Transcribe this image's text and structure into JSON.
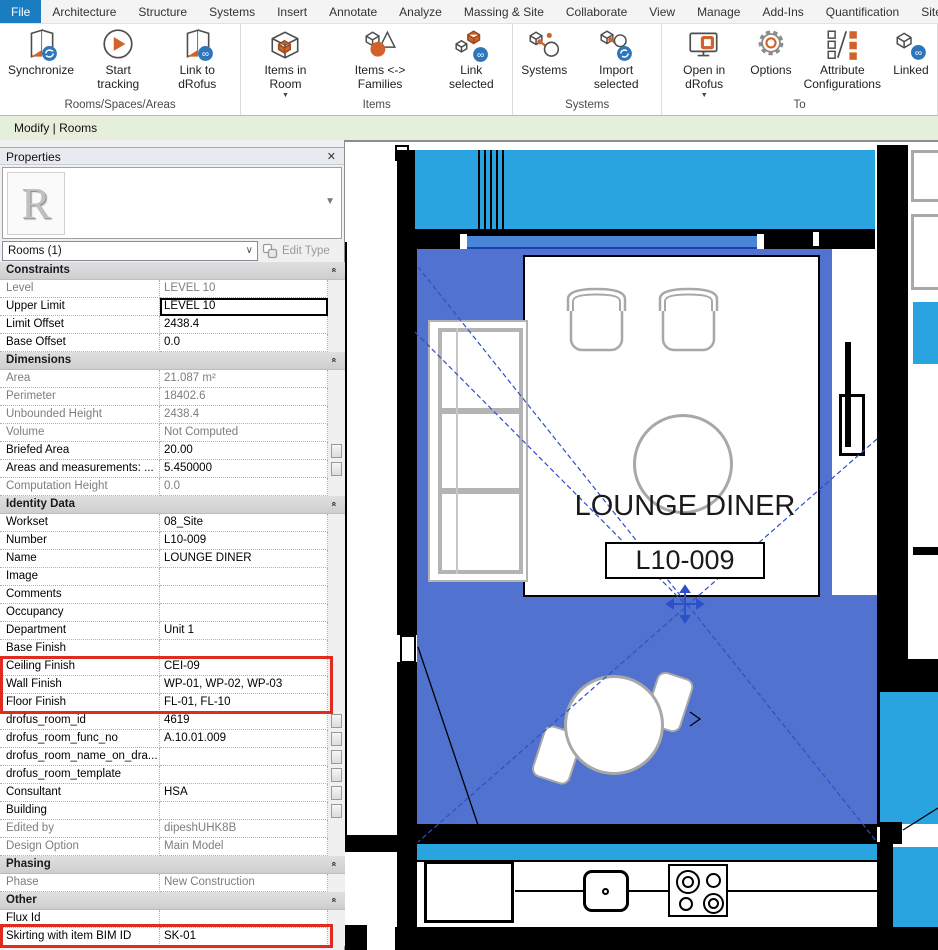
{
  "ui_colors": {
    "file_tab": "#1a7dc2",
    "highlight_red": "#e02b20",
    "accent_orange": "#d2622a",
    "drofus_blue": "#2d76bc"
  },
  "ribbon": {
    "tabs": [
      {
        "label": "File",
        "active": true
      },
      {
        "label": "Architecture"
      },
      {
        "label": "Structure"
      },
      {
        "label": "Systems"
      },
      {
        "label": "Insert"
      },
      {
        "label": "Annotate"
      },
      {
        "label": "Analyze"
      },
      {
        "label": "Massing & Site"
      },
      {
        "label": "Collaborate"
      },
      {
        "label": "View"
      },
      {
        "label": "Manage"
      },
      {
        "label": "Add-Ins"
      },
      {
        "label": "Quantification"
      },
      {
        "label": "Site Des"
      }
    ],
    "groups": [
      {
        "label": "Rooms/Spaces/Areas",
        "buttons": [
          {
            "label": "Synchronize",
            "icon": "sync-room"
          },
          {
            "label": "Start tracking",
            "icon": "play"
          },
          {
            "label": "Link to dRofus",
            "icon": "link-room"
          }
        ]
      },
      {
        "label": "Items",
        "buttons": [
          {
            "label": "Items in Room",
            "icon": "item-box",
            "dropdown": true
          },
          {
            "label": "Items <-> Families",
            "icon": "shapes"
          },
          {
            "label": "Link selected",
            "icon": "link-items"
          }
        ]
      },
      {
        "label": "Systems",
        "buttons": [
          {
            "label": "Systems",
            "icon": "systems"
          },
          {
            "label": "Import selected",
            "icon": "import"
          }
        ]
      },
      {
        "label": "To",
        "buttons": [
          {
            "label": "Open in dRofus",
            "icon": "monitor",
            "dropdown": true
          },
          {
            "label": "Options",
            "icon": "gear"
          },
          {
            "label": "Attribute\nConfigurations",
            "icon": "attr"
          },
          {
            "label": "Linked",
            "icon": "linked"
          }
        ]
      }
    ]
  },
  "modify_bar": {
    "label": "Modify | Rooms"
  },
  "properties": {
    "title": "Properties",
    "close_icon": "✕",
    "instance_selector": {
      "label": "Rooms (1)"
    },
    "edit_type_label": "Edit Type",
    "rows": [
      {
        "t": "sec",
        "label": "Constraints"
      },
      {
        "t": "p",
        "label": "Level",
        "value": "LEVEL 10",
        "ro": true
      },
      {
        "t": "p",
        "label": "Upper Limit",
        "value": "LEVEL 10",
        "sel": true
      },
      {
        "t": "p",
        "label": "Limit Offset",
        "value": "2438.4"
      },
      {
        "t": "p",
        "label": "Base Offset",
        "value": "0.0"
      },
      {
        "t": "sec",
        "label": "Dimensions"
      },
      {
        "t": "p",
        "label": "Area",
        "value": "21.087 m²",
        "ro": true
      },
      {
        "t": "p",
        "label": "Perimeter",
        "value": "18402.6",
        "ro": true
      },
      {
        "t": "p",
        "label": "Unbounded Height",
        "value": "2438.4",
        "ro": true
      },
      {
        "t": "p",
        "label": "Volume",
        "value": "Not Computed",
        "ro": true
      },
      {
        "t": "p",
        "label": "Briefed Area",
        "value": "20.00",
        "btn": true
      },
      {
        "t": "p",
        "label": "Areas and measurements: ...",
        "value": "5.450000",
        "btn": true
      },
      {
        "t": "p",
        "label": "Computation Height",
        "value": "0.0",
        "ro": true
      },
      {
        "t": "sec",
        "label": "Identity Data"
      },
      {
        "t": "p",
        "label": "Workset",
        "value": "08_Site"
      },
      {
        "t": "p",
        "label": "Number",
        "value": "L10-009"
      },
      {
        "t": "p",
        "label": "Name",
        "value": "LOUNGE DINER"
      },
      {
        "t": "p",
        "label": "Image",
        "value": ""
      },
      {
        "t": "p",
        "label": "Comments",
        "value": ""
      },
      {
        "t": "p",
        "label": "Occupancy",
        "value": ""
      },
      {
        "t": "p",
        "label": "Department",
        "value": "Unit 1"
      },
      {
        "t": "p",
        "label": "Base Finish",
        "value": ""
      },
      {
        "t": "p",
        "label": "Ceiling Finish",
        "value": "CEI-09",
        "red": true
      },
      {
        "t": "p",
        "label": "Wall Finish",
        "value": "WP-01, WP-02, WP-03",
        "red": true
      },
      {
        "t": "p",
        "label": "Floor Finish",
        "value": "FL-01, FL-10",
        "red": true
      },
      {
        "t": "p",
        "label": "drofus_room_id",
        "value": "4619",
        "btn": true
      },
      {
        "t": "p",
        "label": "drofus_room_func_no",
        "value": "A.10.01.009",
        "btn": true
      },
      {
        "t": "p",
        "label": "drofus_room_name_on_dra...",
        "value": "",
        "btn": true
      },
      {
        "t": "p",
        "label": "drofus_room_template",
        "value": "",
        "btn": true
      },
      {
        "t": "p",
        "label": "Consultant",
        "value": "HSA",
        "btn": true
      },
      {
        "t": "p",
        "label": "Building",
        "value": "",
        "btn": true
      },
      {
        "t": "p",
        "label": "Edited by",
        "value": "dipeshUHK8B",
        "ro": true
      },
      {
        "t": "p",
        "label": "Design Option",
        "value": "Main Model",
        "ro": true
      },
      {
        "t": "sec",
        "label": "Phasing"
      },
      {
        "t": "p",
        "label": "Phase",
        "value": "New Construction",
        "ro": true
      },
      {
        "t": "sec",
        "label": "Other"
      },
      {
        "t": "p",
        "label": "Flux Id",
        "value": ""
      },
      {
        "t": "p",
        "label": "Skirting with item BIM ID",
        "value": "SK-01",
        "red": true
      }
    ]
  },
  "plan": {
    "room_name": "LOUNGE DINER",
    "room_number": "L10-009",
    "colors": {
      "adjacent_cyan": "#2aa4e0",
      "selected_room_blue": "#5173cf",
      "glazing": "#4a86d8",
      "glazing_dark": "#1e3fae",
      "furniture_gray": "#a8a8a8"
    }
  }
}
